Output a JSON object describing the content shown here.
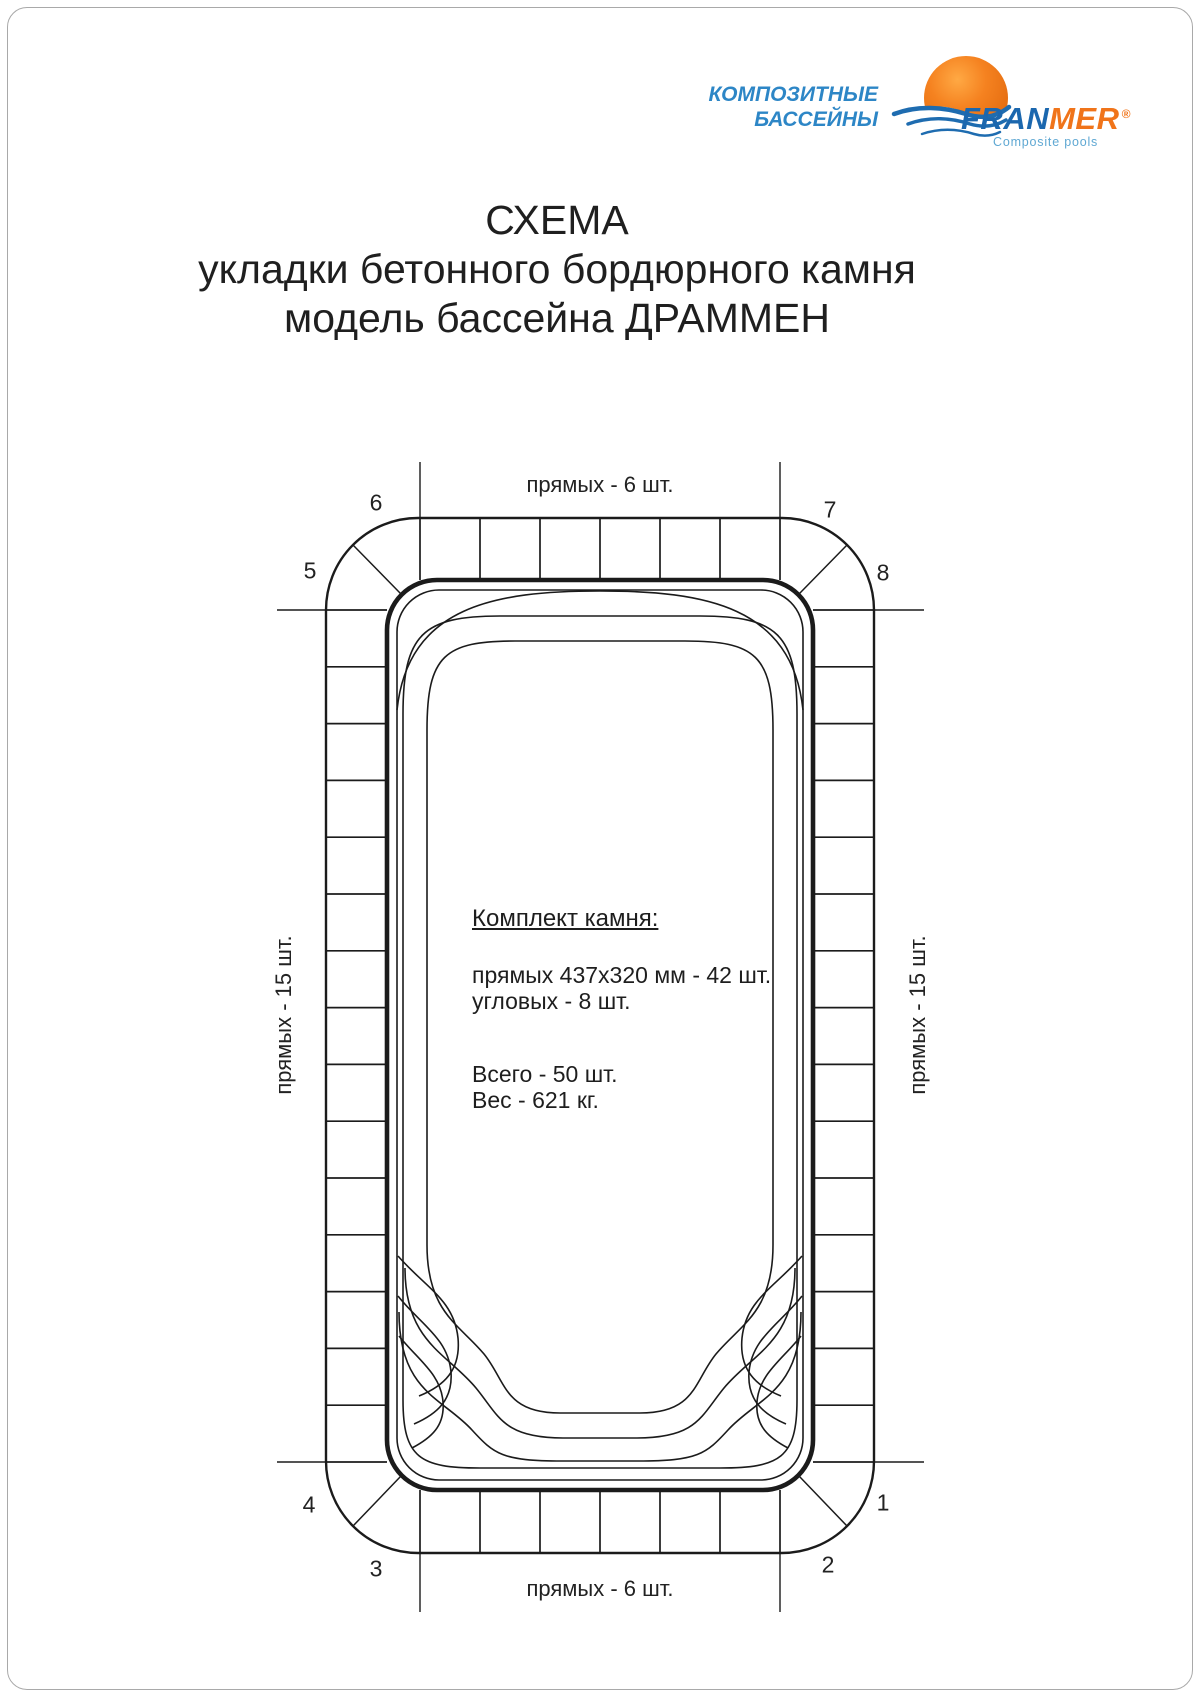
{
  "page": {
    "background": "#ffffff",
    "border_color": "#a9a9a9"
  },
  "logo": {
    "tagline": {
      "line1": "КОМПОЗИТНЫЕ",
      "line2": "БАССЕЙНЫ",
      "color": "#2d86c6"
    },
    "brand": {
      "fran": "FRAN",
      "mer": "MER",
      "registered": "®",
      "fran_color": "#1b67ae",
      "mer_color": "#f0741a"
    },
    "subtitle": {
      "text": "Composite pools",
      "color": "#5fa8d3"
    },
    "mark_colors": {
      "sphere": "#ef7c18",
      "sphere_light": "#ffa944",
      "wave_blue": "#1e6cb0"
    }
  },
  "title": {
    "line1": "СХЕМА",
    "line2": "укладки бетонного бордюрного камня",
    "line3": "модель бассейна ДРАММЕН"
  },
  "diagram": {
    "top_label": "прямых - 6 шт.",
    "bottom_label": "прямых - 6 шт.",
    "left_label": "прямых - 15 шт.",
    "right_label": "прямых - 15 шт.",
    "corner_labels": {
      "c1": "1",
      "c2": "2",
      "c3": "3",
      "c4": "4",
      "c5": "5",
      "c6": "6",
      "c7": "7",
      "c8": "8"
    },
    "stones": {
      "top_straight_count": 6,
      "bottom_straight_count": 6,
      "left_straight_count": 15,
      "right_straight_count": 15,
      "corner_stone_count": 8,
      "straight_total": 42,
      "total": 50,
      "weight_kg": 621,
      "stone_size_mm": "437х320"
    },
    "spec": {
      "heading": "Комплект камня:",
      "straight_line": "прямых 437х320 мм - 42 шт.",
      "corner_line": "угловых - 8 шт.",
      "total_line": "Всего - 50 шт.",
      "weight_line": "Вес - 621 кг."
    },
    "stroke_color": "#1b1b1b"
  }
}
